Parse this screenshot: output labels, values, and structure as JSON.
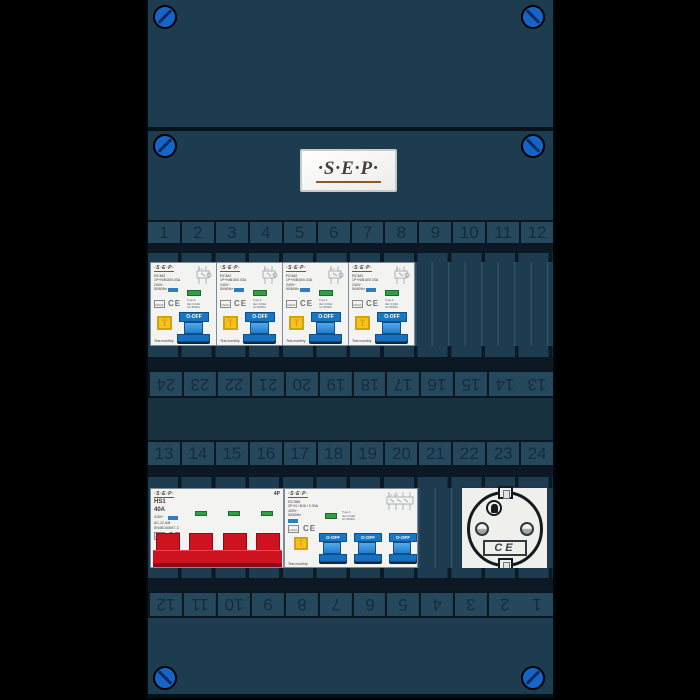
{
  "logo": {
    "text": "·S·E·P·"
  },
  "strips": {
    "top": [
      "1",
      "2",
      "3",
      "4",
      "5",
      "6",
      "7",
      "8",
      "9",
      "10",
      "11",
      "12"
    ],
    "mid_upper": [
      "24",
      "23",
      "22",
      "21",
      "20",
      "19",
      "18",
      "17",
      "16",
      "15",
      "14",
      "13"
    ],
    "mid_lower": [
      "13",
      "14",
      "15",
      "16",
      "17",
      "18",
      "19",
      "20",
      "21",
      "22",
      "23",
      "24"
    ],
    "bottom": [
      "12",
      "11",
      "10",
      "9",
      "8",
      "7",
      "6",
      "5",
      "4",
      "3",
      "2",
      "1"
    ]
  },
  "rcbo": {
    "count": 4,
    "brand": "·S·E·P·",
    "model": "RCM2",
    "spec": "1P+N/B16/0.03A",
    "voltage": "240V~",
    "frequency": "50/60Hz",
    "approval": "KEMA",
    "ce_mark": "CE",
    "type_label": "Type A",
    "idn_label": "IΔn=0.03A",
    "im_label": "Im=6000A",
    "switch_label": "O-OFF",
    "test_button_label": "T",
    "note": "Test monthly"
  },
  "main_switch": {
    "brand": "·S·E·P·",
    "model": "HS1",
    "rating": "40A",
    "voltage": "415V~",
    "utilization": "AC-22 A/B",
    "standard": "EN/IEC60947-3",
    "approval": "KEMA",
    "ce_mark": "CE",
    "poles": "4P"
  },
  "rcd": {
    "switch_count": 3,
    "brand": "·S·E·P·",
    "model": "RC386",
    "spec": "3P+N / B16 / 0.03A",
    "voltage": "400V~",
    "frequency": "50/60Hz",
    "approval": "KEMA",
    "ce_mark": "CE",
    "type_label": "Type A",
    "idn_label": "IΔn=0.03A",
    "im_label": "Im=6000A",
    "switch_label": "O-OFF",
    "test_button_label": "T",
    "note": "Test monthly"
  },
  "socket": {
    "ce_mark": "CE"
  },
  "colors": {
    "panel": "#1e3c50",
    "screw_blue": "#1565c8",
    "switch_blue": "#1777c5",
    "test_yellow": "#f4c41c",
    "handle_red": "#ce1220",
    "indicator_green": "#2f9e44"
  }
}
